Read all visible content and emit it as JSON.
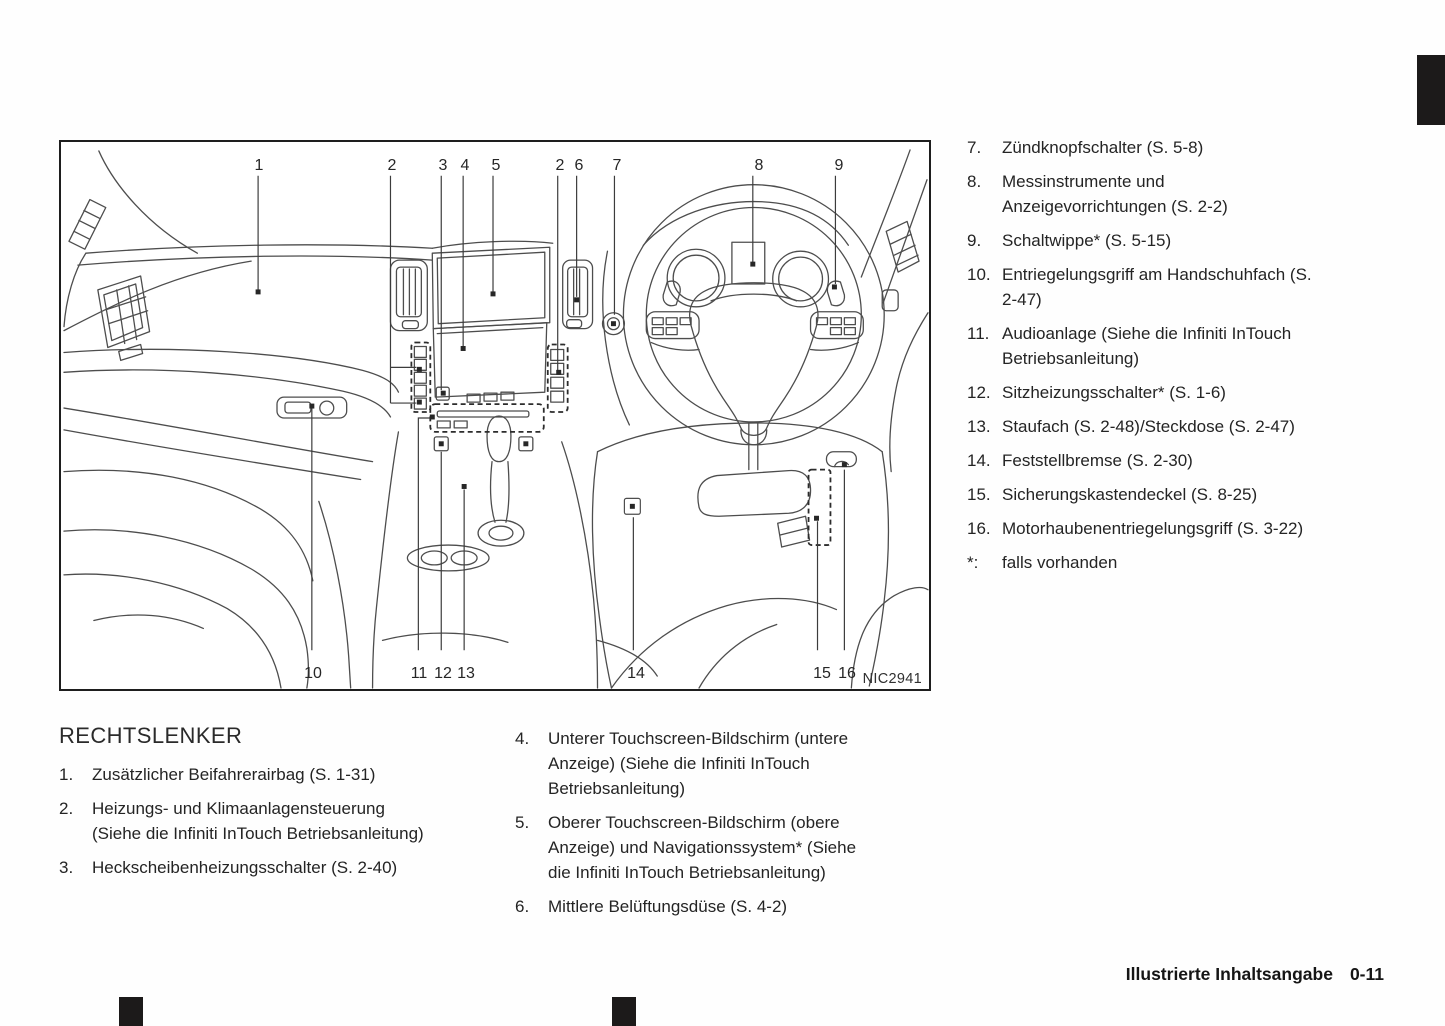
{
  "figure": {
    "code": "NIC2941",
    "callouts": [
      "1",
      "2",
      "3",
      "4",
      "5",
      "2",
      "6",
      "7",
      "8",
      "9",
      "10",
      "11",
      "12",
      "13",
      "14",
      "15",
      "16"
    ]
  },
  "section": {
    "heading": "RECHTSLENKER"
  },
  "lists": {
    "left": [
      {
        "num": "1.",
        "text": "Zusätzlicher Beifahrerairbag (S. 1-31)"
      },
      {
        "num": "2.",
        "text": "Heizungs- und Klimaanlagensteuerung (Siehe die Infiniti InTouch Betriebsanleitung)"
      },
      {
        "num": "3.",
        "text": "Heckscheibenheizungsschalter (S. 2-40)"
      }
    ],
    "middle": [
      {
        "num": "4.",
        "text": "Unterer Touchscreen-Bildschirm (untere Anzeige) (Siehe die Infiniti InTouch Betriebsanleitung)"
      },
      {
        "num": "5.",
        "text": "Oberer Touchscreen-Bildschirm (obere Anzeige) und Navigationssystem* (Siehe die Infiniti InTouch Betriebsanleitung)"
      },
      {
        "num": "6.",
        "text": "Mittlere Belüftungsdüse (S. 4-2)"
      }
    ],
    "right": [
      {
        "num": "7.",
        "text": "Zündknopfschalter (S. 5-8)"
      },
      {
        "num": "8.",
        "text": "Messinstrumente und Anzeigevorrichtungen (S. 2-2)"
      },
      {
        "num": "9.",
        "text": "Schaltwippe* (S. 5-15)"
      },
      {
        "num": "10.",
        "text": "Entriegelungsgriff am Handschuhfach (S. 2-47)"
      },
      {
        "num": "11.",
        "text": "Audioanlage (Siehe die Infiniti InTouch Betriebsanleitung)"
      },
      {
        "num": "12.",
        "text": "Sitzheizungsschalter* (S. 1-6)"
      },
      {
        "num": "13.",
        "text": "Staufach (S. 2-48)/Steckdose (S. 2-47)"
      },
      {
        "num": "14.",
        "text": "Feststellbremse (S. 2-30)"
      },
      {
        "num": "15.",
        "text": "Sicherungskastendeckel (S. 8-25)"
      },
      {
        "num": "16.",
        "text": "Motorhaubenentriegelungsgriff (S. 3-22)"
      },
      {
        "num": "*:",
        "text": "falls vorhanden"
      }
    ]
  },
  "footer": {
    "title": "Illustrierte Inhaltsangabe",
    "page": "0-11"
  }
}
